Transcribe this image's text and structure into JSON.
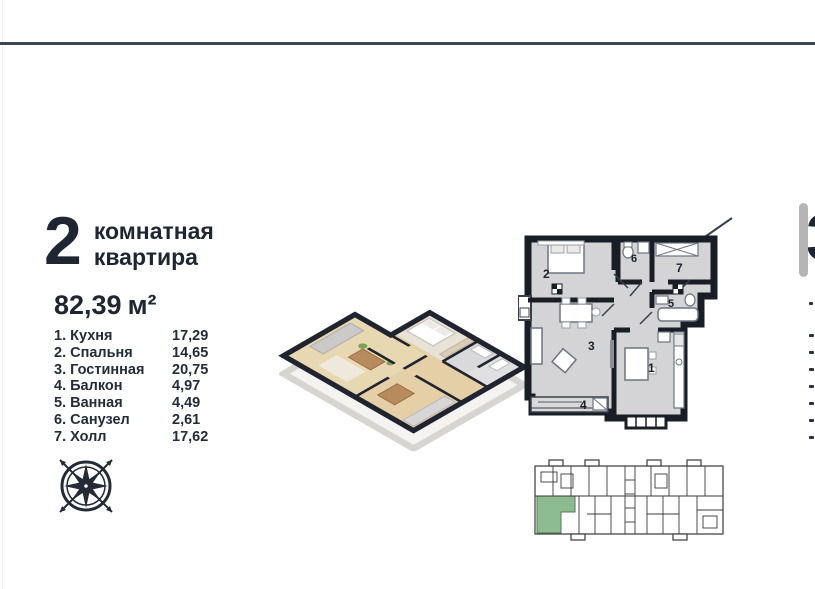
{
  "page": {
    "background": "#ffffff",
    "rule_color": "#3c4650"
  },
  "apartment": {
    "rooms_count": "2",
    "type_line1": "комнатная",
    "type_line2": "квартира",
    "area_value": "82,39",
    "area_unit": "м²"
  },
  "rooms": [
    {
      "label": "1. Кухня",
      "area": "17,29"
    },
    {
      "label": "2. Спальня",
      "area": "14,65"
    },
    {
      "label": "3. Гостинная",
      "area": "20,75"
    },
    {
      "label": "4. Балкон",
      "area": "4,97"
    },
    {
      "label": "5. Ванная",
      "area": "4,49"
    },
    {
      "label": "6. Санузел",
      "area": "2,61"
    },
    {
      "label": "7. Холл",
      "area": "17,62"
    }
  ],
  "plan2d": {
    "labels": [
      "1",
      "2",
      "3",
      "4",
      "5",
      "6",
      "7"
    ]
  },
  "key_plan": {
    "highlight_color": "#8cbb8f"
  },
  "next_page": {
    "partial_digit": "3"
  },
  "colors": {
    "text_dark": "#1f2631",
    "wall": "#191d26",
    "floor_gray": "#d4d4d6",
    "scrollbar": "#b5b5b5"
  }
}
